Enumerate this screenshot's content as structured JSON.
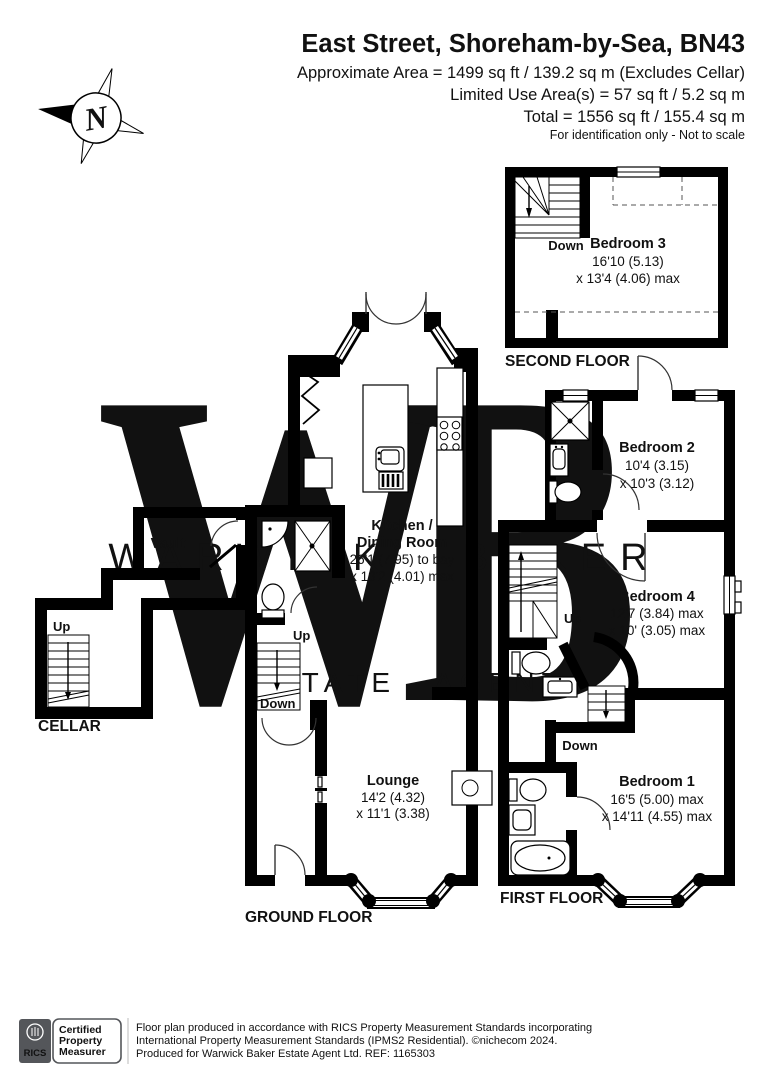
{
  "header": {
    "title": "East Street, Shoreham-by-Sea, BN43",
    "area_line1": "Approximate Area = 1499 sq ft / 139.2 sq m (Excludes Cellar)",
    "area_line2": "Limited Use Area(s) = 57 sq ft / 5.2 sq m",
    "area_line3": "Total = 1556 sq ft / 155.4 sq m",
    "note": "For identification only - Not to scale"
  },
  "compass": {
    "letter": "N"
  },
  "watermark": {
    "letter1": "W",
    "letter2": "B",
    "line1": "WARWICK BAKER",
    "line2": "ESTATE AGENT"
  },
  "floors": {
    "second": {
      "label": "SECOND FLOOR",
      "down_label": "Down",
      "bedroom3": {
        "name": "Bedroom 3",
        "dim1": "16'10 (5.13)",
        "dim2": "x 13'4 (4.06) max"
      }
    },
    "first": {
      "label": "FIRST FLOOR",
      "up_label": "Up",
      "down_label": "Down",
      "bedroom2": {
        "name": "Bedroom 2",
        "dim1": "10'4 (3.15)",
        "dim2": "x 10'3 (3.12)"
      },
      "bedroom4": {
        "name": "Bedroom 4",
        "dim1": "12'7 (3.84) max",
        "dim2": "x 10' (3.05) max"
      },
      "bedroom1": {
        "name": "Bedroom 1",
        "dim1": "16'5 (5.00) max",
        "dim2": "x 14'11 (4.55) max"
      }
    },
    "ground": {
      "label": "GROUND FLOOR",
      "up_label": "Up",
      "down_label": "Down",
      "kitchen": {
        "name_line1": "Kitchen /",
        "name_line2": "Dining Room",
        "dim1": "26'1 (7.95) to bay",
        "dim2": "x 13'2 (4.01) max"
      },
      "lounge": {
        "name": "Lounge",
        "dim1": "14'2 (4.32)",
        "dim2": "x 11'1 (3.38)"
      }
    },
    "cellar": {
      "label": "CELLAR",
      "up_label": "Up",
      "vault_label": "Vault"
    }
  },
  "footer": {
    "rics": "RICS",
    "cert_line1": "Certified",
    "cert_line2": "Property",
    "cert_line3": "Measurer",
    "line1": "Floor plan produced in accordance with RICS Property Measurement Standards incorporating",
    "line2": "International Property Measurement Standards (IPMS2 Residential).  ©nichecom 2024.",
    "line3": "Produced for Warwick Baker Estate Agent Ltd.   REF:  1165303"
  },
  "colors": {
    "wall": "#000000",
    "watermark_letters": "#f8e2ad",
    "watermark_text": "#bdbdbd",
    "rics_badge": "#54565a",
    "footer_text": "#6b6b6b"
  }
}
